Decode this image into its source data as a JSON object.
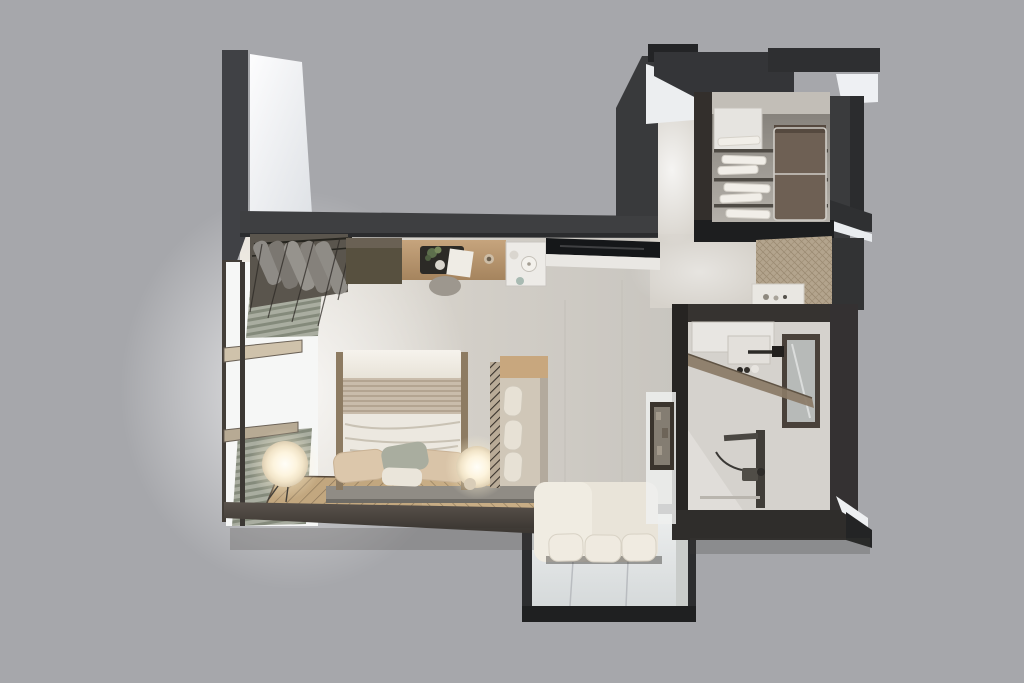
{
  "canvas": {
    "width": 1024,
    "height": 683
  },
  "scene": {
    "type": "3d-floorplan-render",
    "view": "top-down-dollhouse",
    "description": "Photorealistic top-down 3D render of a studio apartment floor plan centered on a flat gray background. No text labels are present in the image.",
    "background_color": "#a6a7ab"
  },
  "palette": {
    "background": "#a6a7ab",
    "wall_dark": "#3a3b3e",
    "wall_shadow": "#27282a",
    "wall_white_face": "#f2f4f6",
    "floor_main": "#d3cfc8",
    "floor_bright": "#e9e4db",
    "floor_entry": "#d8d4cd",
    "wood_counter": "#b99671",
    "counter_black": "#17181a",
    "cabinet_brown": "#5a5244",
    "kitchenette_white": "#edebe7",
    "bed_linen_white": "#f0ece4",
    "bed_throw_ribbed": "#c9bcab",
    "pillow_beige": "#dcc7ab",
    "pillow_sage": "#a9ad9f",
    "bed_platform": "#908c85",
    "rug_tan": "#c2a77f",
    "rug_line": "#6f5e45",
    "lamp_glow": "#fff6e3",
    "bench_wood": "#c8a77e",
    "bench_fabric": "#d0c7b8",
    "sofa_cream": "#e9e4d9",
    "bay_glass": "#e3e6e6",
    "bay_frame": "#2c2d2f",
    "curtain_sage": "#9ba092",
    "bathroom_floor": "#d5d2cd",
    "mirror_frame": "#49413a",
    "shower_glass_bronze": "#8a7a66",
    "laundry_basket_brown": "#6e6054",
    "folded_linen_white": "#f1eee8",
    "doormat_beige": "#b5a68f",
    "bottom_wall_brown": "#4a443f"
  },
  "rooms": [
    {
      "name": "bedroom-living-area",
      "furniture": [
        "open-wardrobe-rack",
        "hanging-clothes",
        "brown-cabinet",
        "wood-desk-counter",
        "serving-tray",
        "potted-plant",
        "notebook",
        "coffee-cup",
        "stool",
        "kitchenette-counter",
        "kettle",
        "bowl",
        "double-bed",
        "folded-duvet",
        "ribbed-throw",
        "pillows",
        "sphere-floor-lamp-left",
        "sphere-floor-lamp-right",
        "herringbone-rug",
        "upholstered-bench",
        "black-countertop"
      ]
    },
    {
      "name": "window-wall",
      "furniture": [
        "full-height-windows",
        "pleated-curtain-top",
        "pleated-curtain-bottom",
        "wood-sill-bars"
      ]
    },
    {
      "name": "entry-hall",
      "furniture": [
        "linen-closet",
        "white-cabinet",
        "closet-shelves",
        "folded-linens",
        "laundry-basket",
        "doormat",
        "console-shelf",
        "toiletry-bottles"
      ]
    },
    {
      "name": "bathroom",
      "furniture": [
        "storage-cabinet",
        "wall-mirror",
        "wall-hung-sink",
        "faucet",
        "toiletries",
        "bronze-glass-screen",
        "shower-column",
        "hand-shower",
        "wall-art-frame"
      ]
    },
    {
      "name": "bay-window-nook",
      "furniture": [
        "chaise-sofa",
        "back-cushions",
        "glazed-bay-window"
      ]
    }
  ]
}
